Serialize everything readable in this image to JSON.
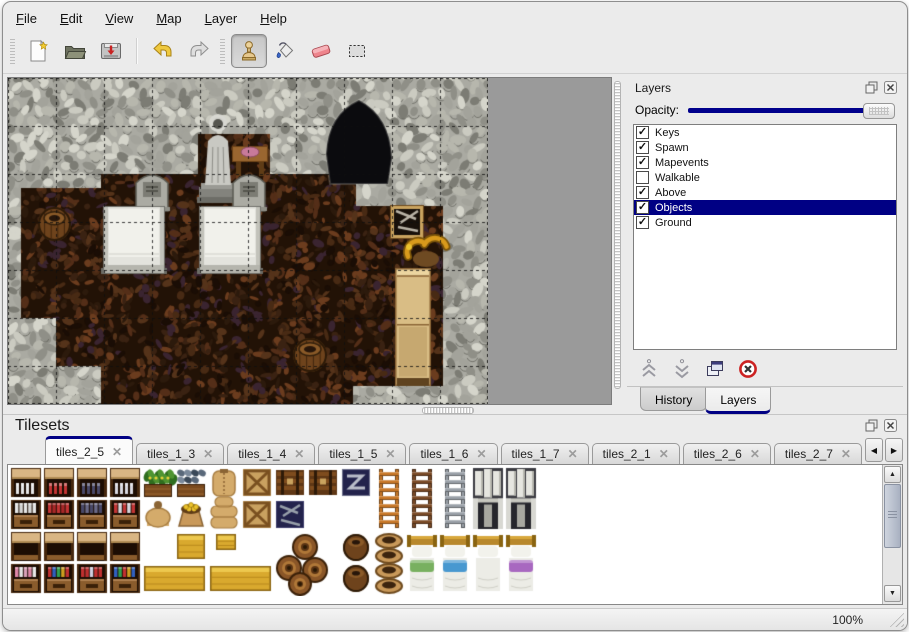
{
  "menu": {
    "items": [
      "File",
      "Edit",
      "View",
      "Map",
      "Layer",
      "Help"
    ]
  },
  "toolbar": {
    "buttons": [
      "new-file",
      "open-file",
      "save-file",
      "undo",
      "redo",
      "stamp-tool",
      "fill-tool",
      "eraser-tool",
      "select-tool"
    ],
    "active_tool": "stamp-tool"
  },
  "icons": {
    "left": "◀",
    "right": "▶",
    "up": "▲",
    "down": "▼"
  },
  "layers_panel": {
    "title": "Layers",
    "opacity_label": "Opacity:",
    "opacity_value_percent": 100,
    "accent_color": "#000084",
    "items": [
      {
        "label": "Keys",
        "check": "✓"
      },
      {
        "label": "Spawn",
        "check": "✓"
      },
      {
        "label": "Mapevents",
        "check": "✓"
      },
      {
        "label": "Walkable",
        "check": ""
      },
      {
        "label": "Above",
        "check": "✓"
      },
      {
        "label": "Objects",
        "check": "✓",
        "selected": true
      },
      {
        "label": "Ground",
        "check": "✓"
      }
    ],
    "tabs": [
      {
        "label": "History",
        "active": false
      },
      {
        "label": "Layers",
        "active": true
      }
    ]
  },
  "tilesets_panel": {
    "title": "Tilesets",
    "close_glyph": "✕",
    "tabs": [
      {
        "label": "tiles_2_5",
        "active": true
      },
      {
        "label": "tiles_1_3",
        "active": false
      },
      {
        "label": "tiles_1_4",
        "active": false
      },
      {
        "label": "tiles_1_5",
        "active": false
      },
      {
        "label": "tiles_1_6",
        "active": false
      },
      {
        "label": "tiles_1_7",
        "active": false
      },
      {
        "label": "tiles_2_1",
        "active": false
      },
      {
        "label": "tiles_2_6",
        "active": false
      },
      {
        "label": "tiles_2_7",
        "active": false
      },
      {
        "label": "tiles_3",
        "active": false
      }
    ]
  },
  "status_bar": {
    "zoom_level": "100%"
  },
  "map_view": {
    "width": 480,
    "height": 326,
    "tile_px": 48,
    "colors": {
      "wall_base": "#aaaaa2",
      "floor_base": "#221206",
      "grid": "rgba(15,15,15,0.8)",
      "empty": "#9a9a9a"
    },
    "floor_rects": [
      [
        190,
        56,
        72,
        56
      ],
      [
        93,
        96,
        255,
        48
      ],
      [
        13,
        110,
        82,
        130
      ],
      [
        13,
        144,
        335,
        48
      ],
      [
        345,
        128,
        90,
        180
      ],
      [
        48,
        192,
        300,
        48
      ],
      [
        48,
        240,
        342,
        48
      ],
      [
        93,
        288,
        252,
        38
      ]
    ],
    "objects": [
      {
        "t": "cave",
        "x": 318,
        "y": 22,
        "w": 66,
        "h": 84
      },
      {
        "t": "statue",
        "x": 193,
        "y": 29,
        "w": 34,
        "h": 96
      },
      {
        "t": "table",
        "x": 224,
        "y": 64,
        "w": 36,
        "h": 36
      },
      {
        "t": "tombstone",
        "x": 128,
        "y": 95,
        "w": 32,
        "h": 38
      },
      {
        "t": "tombstone",
        "x": 225,
        "y": 95,
        "w": 32,
        "h": 38
      },
      {
        "t": "tomb",
        "x": 95,
        "y": 128,
        "w": 62,
        "h": 68
      },
      {
        "t": "tomb",
        "x": 191,
        "y": 128,
        "w": 62,
        "h": 68
      },
      {
        "t": "barrel",
        "x": 30,
        "y": 128,
        "w": 33,
        "h": 36
      },
      {
        "t": "toolcrate",
        "x": 382,
        "y": 127,
        "w": 34,
        "h": 34
      },
      {
        "t": "cabinet",
        "x": 387,
        "y": 190,
        "w": 36,
        "h": 118
      },
      {
        "t": "horn",
        "x": 392,
        "y": 152,
        "w": 52,
        "h": 40
      },
      {
        "t": "barrel",
        "x": 285,
        "y": 259,
        "w": 34,
        "h": 36
      }
    ]
  },
  "palette": {
    "cell_w": 33,
    "cell_h": 32,
    "cols": 16,
    "rows": 4,
    "sprites": [
      {
        "t": "shelf_top",
        "c": 0,
        "r": 0,
        "v": "#e6e6e6"
      },
      {
        "t": "shelf_top",
        "c": 1,
        "r": 0,
        "v": "#c23434"
      },
      {
        "t": "shelf_top",
        "c": 2,
        "r": 0,
        "v": "#484868"
      },
      {
        "t": "shelf_top",
        "c": 3,
        "r": 0,
        "v": "#d8d8e0"
      },
      {
        "t": "plant_box",
        "c": 4,
        "r": 0
      },
      {
        "t": "fish_box",
        "c": 5,
        "r": 0
      },
      {
        "t": "sack_tall",
        "c": 6,
        "r": 0
      },
      {
        "t": "crate_x",
        "c": 7,
        "r": 0
      },
      {
        "t": "chest_brown",
        "c": 8,
        "r": 0
      },
      {
        "t": "chest_brown",
        "c": 9,
        "r": 0
      },
      {
        "t": "chest_z",
        "c": 10,
        "r": 0
      },
      {
        "t": "ladder",
        "c": 11,
        "r": 0,
        "h": 2,
        "v": "#c87828"
      },
      {
        "t": "ladder",
        "c": 12,
        "r": 0,
        "h": 2,
        "v": "#7a4a26"
      },
      {
        "t": "ladder",
        "c": 13,
        "r": 0,
        "h": 2,
        "v": "#9aa0a8"
      },
      {
        "t": "doorway",
        "c": 14,
        "r": 0,
        "h": 2
      },
      {
        "t": "doorway",
        "c": 15,
        "r": 0,
        "h": 2
      },
      {
        "t": "shelf_bottom",
        "c": 0,
        "r": 1,
        "v": [
          "#e6e6e6",
          "#d8d8d8"
        ]
      },
      {
        "t": "shelf_bottom",
        "c": 1,
        "r": 1,
        "v": [
          "#c23434",
          "#a82828"
        ]
      },
      {
        "t": "shelf_bottom",
        "c": 2,
        "r": 1,
        "v": [
          "#484868",
          "#6a6a8a"
        ]
      },
      {
        "t": "shelf_bottom",
        "c": 3,
        "r": 1,
        "v": [
          "#c23434",
          "#d8d8e0"
        ]
      },
      {
        "t": "big_sack",
        "c": 4,
        "r": 1
      },
      {
        "t": "coin_sack",
        "c": 5,
        "r": 1
      },
      {
        "t": "sack_pile",
        "c": 6,
        "r": 1
      },
      {
        "t": "crate_x",
        "c": 7,
        "r": 1
      },
      {
        "t": "tool_crate",
        "c": 8,
        "r": 1
      },
      {
        "t": "shelf_top",
        "c": 0,
        "r": 2,
        "v": "plain"
      },
      {
        "t": "shelf_top",
        "c": 1,
        "r": 2,
        "v": "plain"
      },
      {
        "t": "shelf_top",
        "c": 2,
        "r": 2,
        "v": "plain"
      },
      {
        "t": "shelf_top",
        "c": 3,
        "r": 2,
        "v": "plain"
      },
      {
        "t": "gold_crate",
        "c": 5,
        "r": 2
      },
      {
        "t": "gold_small",
        "c": 6,
        "r": 2
      },
      {
        "t": "barrel_cluster",
        "c": 8,
        "r": 2,
        "w": 2,
        "h": 2
      },
      {
        "t": "barrel_stack",
        "c": 10,
        "r": 2,
        "h": 2
      },
      {
        "t": "pots",
        "c": 11,
        "r": 2,
        "h": 2
      },
      {
        "t": "bed",
        "c": 12,
        "r": 2,
        "h": 2,
        "v": "#78b060"
      },
      {
        "t": "bed",
        "c": 13,
        "r": 2,
        "h": 2,
        "v": "#4898d0"
      },
      {
        "t": "bed",
        "c": 14,
        "r": 2,
        "h": 2,
        "v": ""
      },
      {
        "t": "bed",
        "c": 15,
        "r": 2,
        "h": 2,
        "v": "#a868c0"
      },
      {
        "t": "shelf_bottom",
        "c": 0,
        "r": 3,
        "v": [
          "#e088a8",
          "#e8e8e8",
          "#d8a0b8"
        ]
      },
      {
        "t": "shelf_bottom",
        "c": 1,
        "r": 3,
        "v": [
          "#c03030",
          "#3060c0",
          "#30a050",
          "#d0a020"
        ]
      },
      {
        "t": "shelf_bottom",
        "c": 2,
        "r": 3,
        "v": [
          "#c03030",
          "#c03030",
          "#d0d0e0"
        ]
      },
      {
        "t": "shelf_bottom",
        "c": 3,
        "r": 3,
        "v": [
          "#3060c0",
          "#30a050",
          "#c03030",
          "#d0a020"
        ]
      },
      {
        "t": "gold_wide",
        "c": 4,
        "r": 3,
        "w": 2
      },
      {
        "t": "gold_wide",
        "c": 6,
        "r": 3,
        "w": 2
      }
    ]
  }
}
